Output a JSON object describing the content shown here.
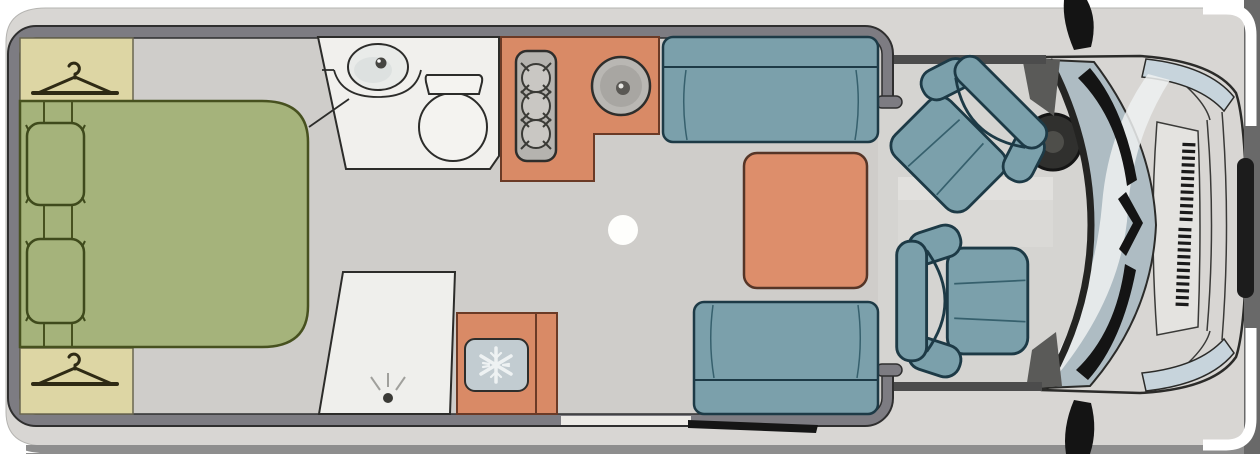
{
  "meta": {
    "title": "Motorhome floor plan",
    "view": "top-down",
    "type": "floor-plan-illustration",
    "text_content": "none (image contains no visible text)"
  },
  "colors": {
    "page_bg": "#ffffff",
    "edge_band": "#696969",
    "bottom_strip": "#8e8e8e",
    "body": "#d8d6d3",
    "wall": "#7d7c82",
    "floor": "#cfcdca",
    "cab_floor": "#d5d4d1",
    "cab_band_light": "#e1e0dd",
    "cab_band_mid": "#dad9d6",
    "wardrobe": "#ddd6a4",
    "bed": "#a5b37b",
    "bed_outline": "#47511f",
    "bath_white": "#f1f0ed",
    "fixture_white": "#f4f3f0",
    "counter_orange": "#d98a66",
    "orange_outline": "#6b3a26",
    "table_orange": "#dd8e6b",
    "sofa": "#7ba0ab",
    "sofa_outline": "#1d3a46",
    "sofa_seam": "#36606d",
    "fridge_panel": "#c2ccd1",
    "snowflake": "#eef2f3",
    "stove_gray": "#b5b3af",
    "burner_gray": "#c9c7c3",
    "sink_gray": "#b9b7b3",
    "glass": "#aebcc3",
    "glass_highlight": "#eef1f1",
    "headlight": "#c7d4dc",
    "grille_panel": "#e4e3e0",
    "black_detail": "#141414",
    "wheel_dark": "#30302e",
    "cab_wall_dark": "#4c4c4c"
  },
  "rooms": {
    "bedroom": {
      "label": "rear bedroom",
      "furniture": [
        "wardrobe-top",
        "wardrobe-bottom",
        "double-bed",
        "pillow-top",
        "pillow-bottom"
      ],
      "icons": [
        "hanger-icon",
        "hanger-icon"
      ]
    },
    "bathroom": {
      "label": "bathroom",
      "furniture": [
        "washbasin",
        "toilet"
      ],
      "icons": [
        "drain-dot"
      ]
    },
    "shower": {
      "label": "shower cubicle",
      "icons": [
        "shower-drain-icon"
      ]
    },
    "kitchen": {
      "label": "kitchen",
      "furniture": [
        "three-burner-stove",
        "round-sink",
        "fridge"
      ],
      "icons": [
        "snowflake-icon"
      ]
    },
    "lounge": {
      "label": "lounge dinette",
      "furniture": [
        "sofa-top",
        "sofa-bottom",
        "dining-table",
        "ceiling-light-dot",
        "entry-step"
      ]
    },
    "cab": {
      "label": "driver cab",
      "furniture": [
        "driver-swivel-seat",
        "passenger-swivel-seat",
        "steering-wheel",
        "windshield",
        "wiper-blades",
        "side-mirror-top",
        "side-mirror-bottom",
        "headlight-top",
        "headlight-bottom",
        "grille",
        "front-bumper"
      ]
    }
  },
  "counts": {
    "stove_burners": 3,
    "pillows": 2,
    "sofas": 2,
    "cab_seats": 2,
    "wardrobes": 2,
    "grille_slat_columns": 2,
    "side_mirrors": 2,
    "headlights": 2
  }
}
